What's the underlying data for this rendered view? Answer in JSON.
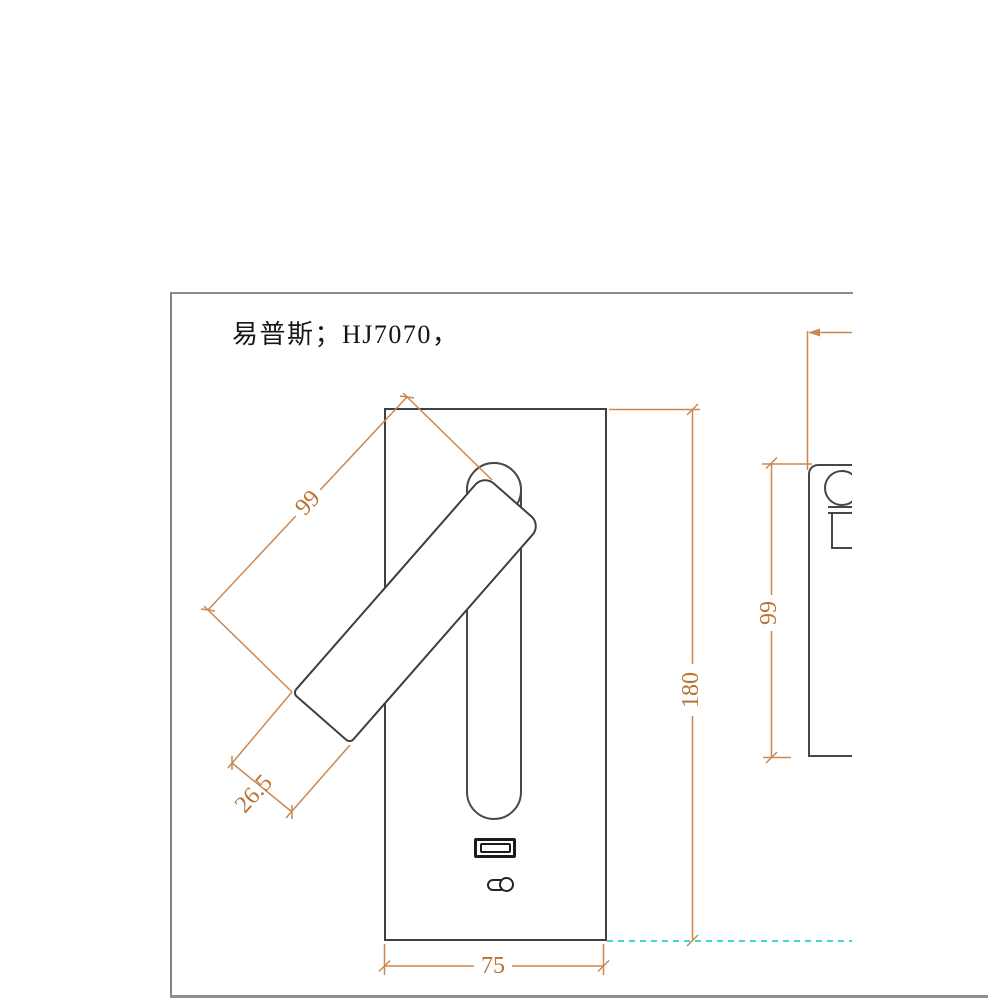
{
  "title": "易普斯；HJ7070，",
  "drawing": {
    "dimensions": {
      "plate_height": "180",
      "plate_width": "75",
      "lamp_length": "99",
      "lamp_head_width": "26.5",
      "side_height": "99"
    },
    "colors": {
      "outline": "#3f4245",
      "dimension_line": "#ca8850",
      "dimension_text": "#b9722f",
      "datum_line": "#45d5d8",
      "frame_border": "#8a8a8a"
    }
  }
}
